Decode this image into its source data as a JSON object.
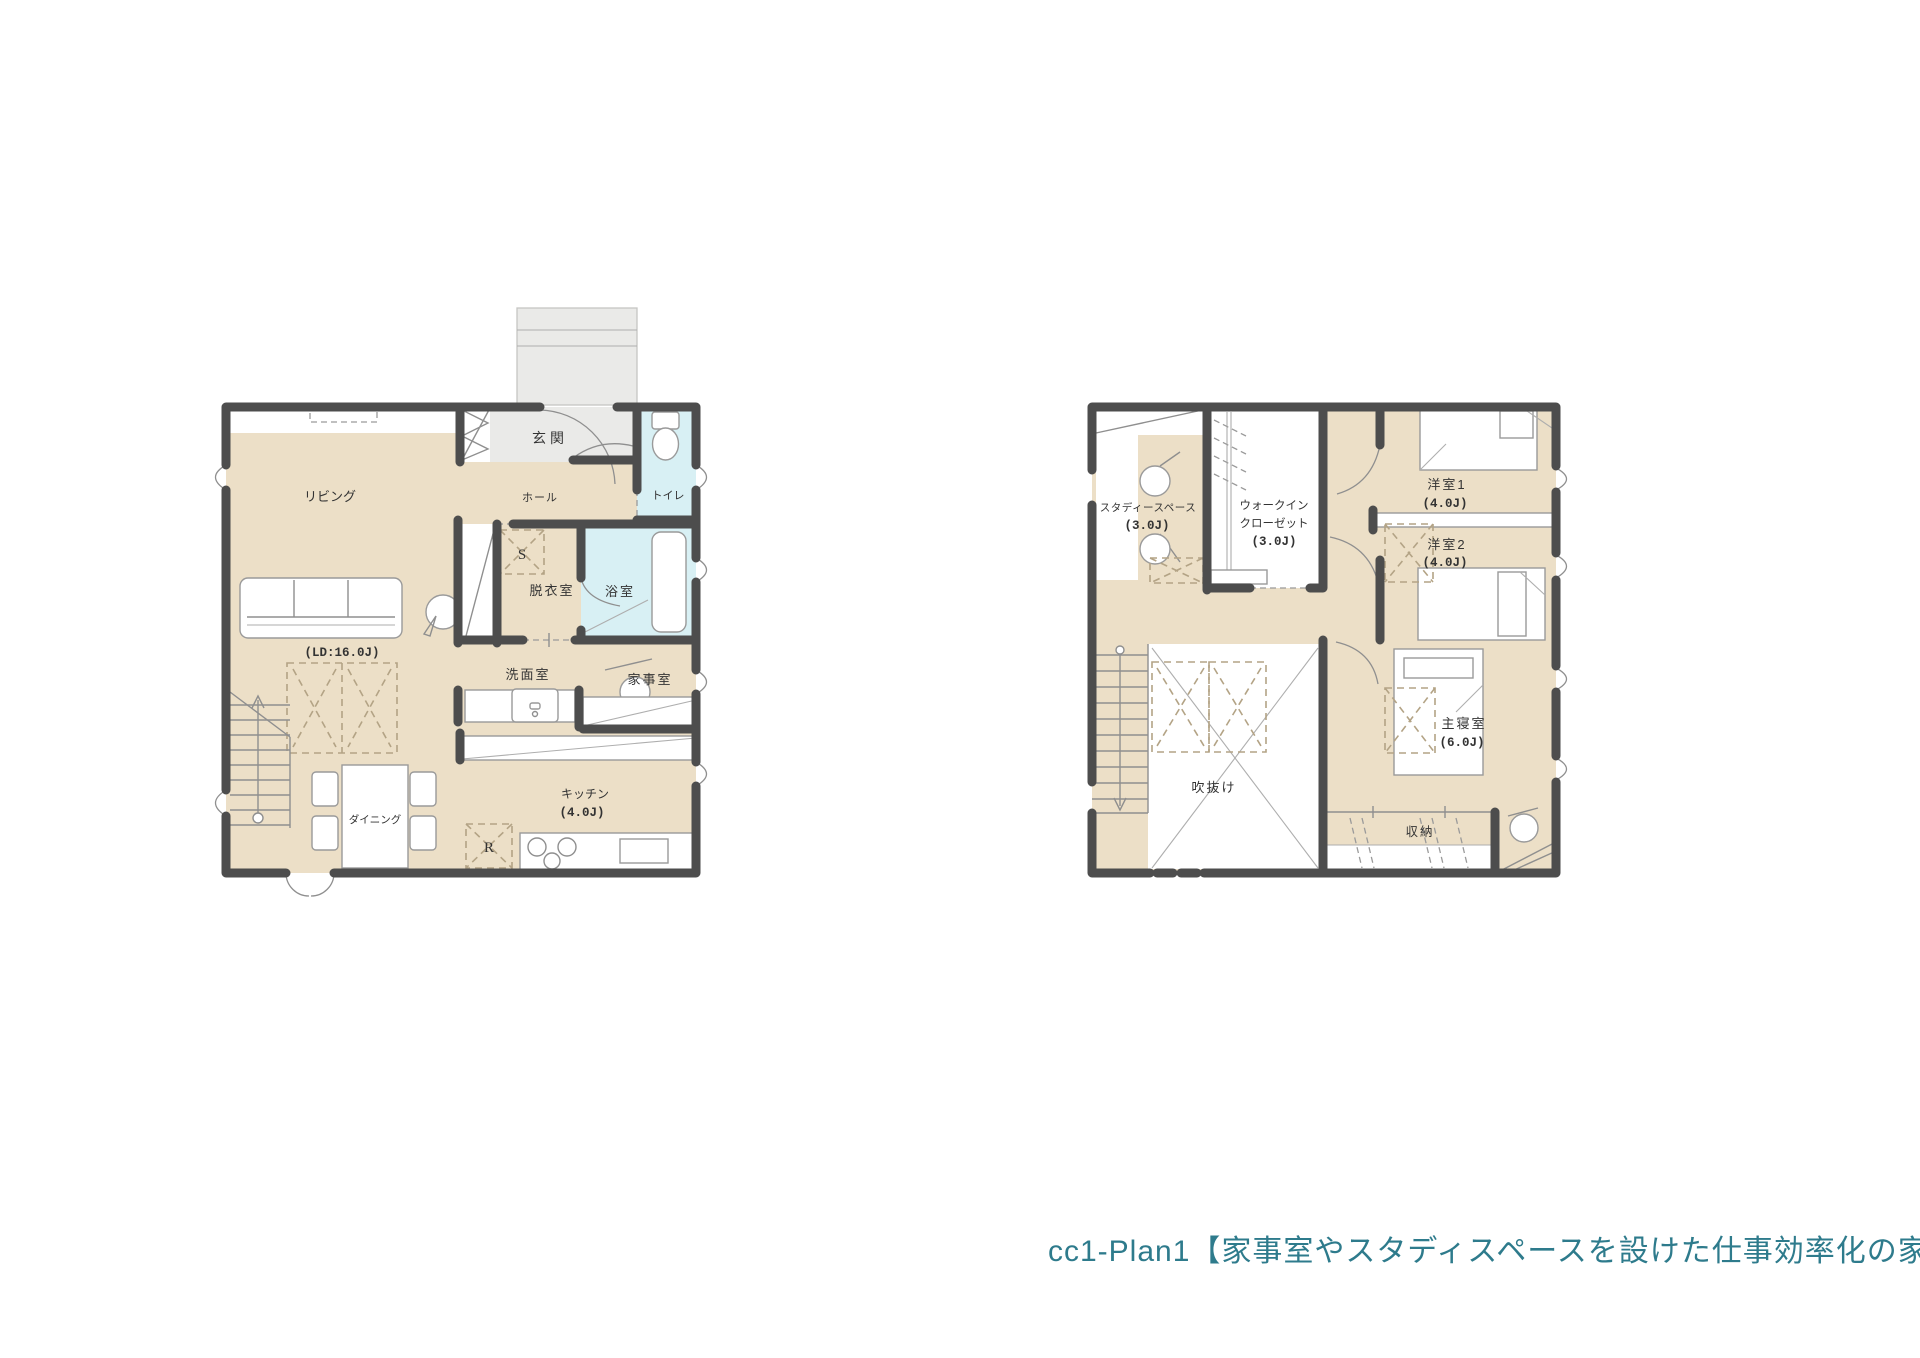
{
  "caption": {
    "text": "cc1-Plan1【家事室やスタディスペースを設けた仕事効率化の家】",
    "color": "#2e7b8c"
  },
  "palette": {
    "floor_beige": "#ecdfc7",
    "wall_dark": "#4d4d4d",
    "water_cyan": "#d8f0f4",
    "entry_gray": "#eaeae8",
    "caption_teal": "#2e7b8c"
  },
  "floor1": {
    "labels": {
      "entry": "玄関",
      "hall": "ホール",
      "living": "リビング",
      "ld_size": "(LD:16.0J)",
      "toilet": "トイレ",
      "closet_s": "S",
      "dressing": "脱衣室",
      "bath": "浴室",
      "washroom": "洗面室",
      "utility": "家事室",
      "dining": "ダイニング",
      "kitchen": "キッチン",
      "kitchen_size": "(4.0J)",
      "fridge_r": "R"
    }
  },
  "floor2": {
    "labels": {
      "study_line1": "スタディースペース",
      "study_line2": "(3.0J)",
      "wic_line1": "ウォークイン",
      "wic_line2": "クローゼット",
      "wic_line3": "(3.0J)",
      "room1": "洋室1",
      "room1_size": "(4.0J)",
      "room2": "洋室2",
      "room2_size": "(4.0J)",
      "void": "吹抜け",
      "master": "主寝室",
      "master_size": "(6.0J)",
      "storage": "収納"
    }
  }
}
